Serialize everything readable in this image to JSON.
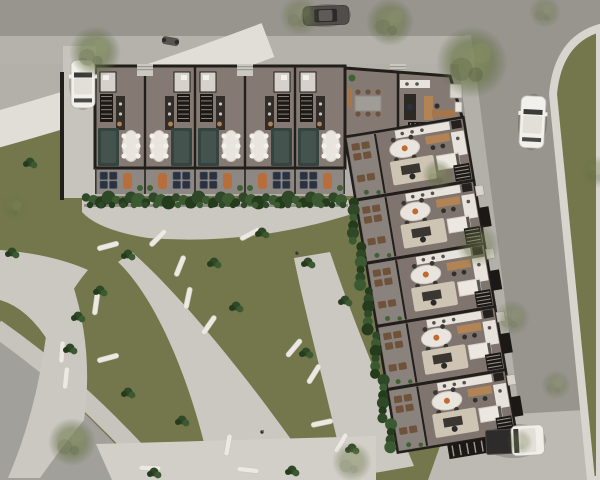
{
  "palette": {
    "asphalt": "#98958f",
    "road2": "#a2a09a",
    "sidewalk": "#b5b2ac",
    "concrete": "#cbc8c1",
    "concreteLight": "#d2cfc8",
    "paleBand": "#e1ded7",
    "apron": "#bdbab3",
    "curb": "#d8d5ce",
    "grass": "#74774b",
    "wall": "#211e1b",
    "floorBar": "#847a73",
    "floorWing": "#7f756e",
    "patio": "#8d8883",
    "patioWing": "#8a837d",
    "hedgeGreens": [
      "#2f4827",
      "#3b5a31",
      "#243b1c"
    ],
    "teal": "#36443f",
    "tealIn": "#44534e",
    "navy": "#2b323f",
    "cream": "#e9e5de",
    "beige": "#cdc4b3",
    "wood": "#b28455",
    "woodDark": "#6f523a",
    "orange": "#bf6a2e",
    "stair": "#1b1815",
    "counter": "#e7e3dc",
    "white": "#f2f0ea",
    "bath": "#d6d2cb",
    "plant": "#3f6134",
    "bench": "#ece9e2",
    "carDark": "#504d4a",
    "shadow": "rgba(20,18,15,0.3)"
  },
  "scene": {
    "bar_units": [
      {
        "x": 95,
        "mirrored": false
      },
      {
        "x": 145,
        "mirrored": true
      },
      {
        "x": 195,
        "mirrored": false
      },
      {
        "x": 245,
        "mirrored": true
      },
      {
        "x": 295,
        "mirrored": false
      }
    ],
    "porches": [
      145,
      245,
      398
    ],
    "wing": {
      "x": 345,
      "y": 137,
      "w": 120,
      "unit_h": 64,
      "count": 5,
      "angle": -9.5
    },
    "hedge_top": {
      "x1": 86,
      "x2": 346,
      "y": 200
    },
    "cars": [
      {
        "name": "car-white-sedan-driveway",
        "kind": "sedanV",
        "x": 71,
        "y": 60,
        "w": 24,
        "h": 48,
        "angle": 0,
        "body": "#f2f0ea"
      },
      {
        "name": "car-dark-sedan-top-road",
        "kind": "sedanH",
        "x": 303,
        "y": 6,
        "w": 46,
        "h": 19,
        "angle": -2,
        "body": "#504d4a"
      },
      {
        "name": "car-white-sedan-right-road",
        "kind": "sedanV",
        "x": 520,
        "y": 96,
        "w": 25,
        "h": 52,
        "angle": 3,
        "body": "#f2f0ea"
      },
      {
        "name": "car-white-pickup-bottom-road",
        "kind": "pickup",
        "x": 486,
        "y": 426,
        "w": 58,
        "h": 30,
        "angle": -3,
        "body": "#f0eee8"
      }
    ],
    "trees": [
      [
        95,
        52,
        26,
        0.75
      ],
      [
        300,
        16,
        20,
        0.5
      ],
      [
        390,
        22,
        24,
        0.7
      ],
      [
        472,
        62,
        36,
        0.85
      ],
      [
        545,
        12,
        16,
        0.45
      ],
      [
        478,
        245,
        22,
        0.5
      ],
      [
        438,
        175,
        16,
        0.55
      ],
      [
        512,
        318,
        18,
        0.45
      ],
      [
        556,
        385,
        15,
        0.4
      ],
      [
        352,
        462,
        20,
        0.5
      ],
      [
        72,
        442,
        24,
        0.7
      ],
      [
        14,
        208,
        14,
        0.4
      ],
      [
        597,
        172,
        16,
        0.4
      ],
      [
        520,
        442,
        13,
        0.35
      ]
    ],
    "benches": [
      [
        108,
        246,
        -15
      ],
      [
        158,
        238,
        -45
      ],
      [
        180,
        266,
        -68
      ],
      [
        188,
        298,
        -78
      ],
      [
        209,
        325,
        -55
      ],
      [
        250,
        234,
        -28
      ],
      [
        294,
        348,
        -50
      ],
      [
        314,
        374,
        -58
      ],
      [
        108,
        358,
        -15
      ],
      [
        62,
        352,
        -86
      ],
      [
        66,
        378,
        -84
      ],
      [
        96,
        304,
        -82
      ],
      [
        150,
        468,
        2
      ],
      [
        248,
        470,
        6
      ],
      [
        228,
        445,
        -80
      ],
      [
        322,
        423,
        -12
      ],
      [
        341,
        443,
        -60
      ]
    ],
    "shrubs": [
      [
        100,
        290
      ],
      [
        78,
        316
      ],
      [
        128,
        254
      ],
      [
        214,
        262
      ],
      [
        262,
        232
      ],
      [
        308,
        262
      ],
      [
        70,
        348
      ],
      [
        128,
        392
      ],
      [
        182,
        420
      ],
      [
        236,
        306
      ],
      [
        306,
        352
      ],
      [
        154,
        472
      ],
      [
        292,
        470
      ],
      [
        352,
        448
      ],
      [
        30,
        162
      ],
      [
        12,
        252
      ],
      [
        345,
        300
      ]
    ],
    "people": [
      [
        297,
        253
      ],
      [
        262,
        432
      ]
    ]
  }
}
